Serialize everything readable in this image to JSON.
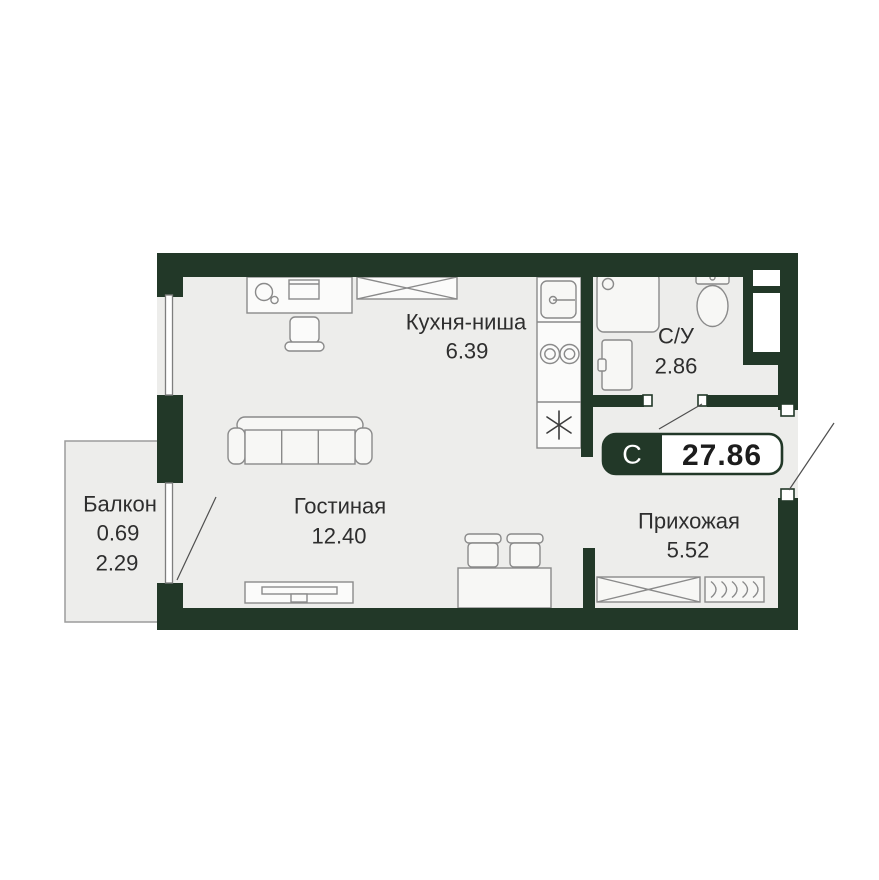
{
  "plan": {
    "type": "studio-apartment-floor-plan",
    "badge": {
      "letter": "С",
      "total_area": "27.86"
    },
    "rooms": {
      "kitchen": {
        "name": "Кухня-ниша",
        "area": "6.39"
      },
      "bathroom": {
        "name": "С/У",
        "area": "2.86"
      },
      "living": {
        "name": "Гостиная",
        "area": "12.40"
      },
      "hallway": {
        "name": "Прихожая",
        "area": "5.52"
      },
      "balcony": {
        "name": "Балкон",
        "area_reduced": "0.69",
        "area_full": "2.29"
      }
    }
  },
  "theme": {
    "wall_color": "#223828",
    "floor_color": "#ededeb",
    "line_color": "#8a8a8a",
    "text_color": "#2e2e2e"
  }
}
